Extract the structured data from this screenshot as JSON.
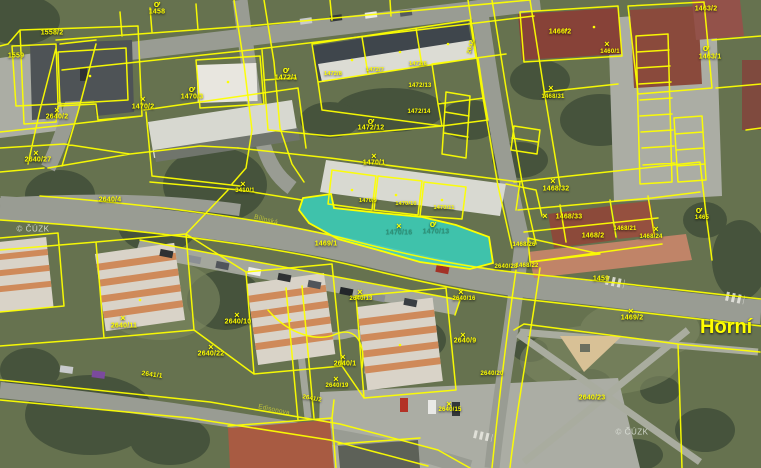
{
  "map": {
    "watermark": "© ČÚZK",
    "area_label": "Horní",
    "selected_parcels": [
      "1470/16",
      "1470/13"
    ],
    "colors": {
      "parcel_line": "#fdff00",
      "highlight_fill": "#35d8c5",
      "label_yellow": "#ffff00",
      "selected_label": "#2f8f76"
    },
    "labels": [
      {
        "t": "×",
        "x": 143,
        "y": 99,
        "k": "sym"
      },
      {
        "t": "×",
        "x": 57,
        "y": 110,
        "k": "sym"
      },
      {
        "t": "×",
        "x": 36,
        "y": 153,
        "k": "sym"
      },
      {
        "t": "×",
        "x": 243,
        "y": 184,
        "k": "sym"
      },
      {
        "t": "×",
        "x": 374,
        "y": 156,
        "k": "sym"
      },
      {
        "t": "×",
        "x": 399,
        "y": 226,
        "k": "sym"
      },
      {
        "t": "×",
        "x": 551,
        "y": 88,
        "k": "sym"
      },
      {
        "t": "×",
        "x": 553,
        "y": 181,
        "k": "sym"
      },
      {
        "t": "×",
        "x": 545,
        "y": 216,
        "k": "sym"
      },
      {
        "t": "×",
        "x": 656,
        "y": 229,
        "k": "sym"
      },
      {
        "t": "×",
        "x": 607,
        "y": 44,
        "k": "sym"
      },
      {
        "t": "×",
        "x": 631,
        "y": 311,
        "k": "sym"
      },
      {
        "t": "×",
        "x": 123,
        "y": 318,
        "k": "sym"
      },
      {
        "t": "×",
        "x": 237,
        "y": 315,
        "k": "sym"
      },
      {
        "t": "×",
        "x": 211,
        "y": 347,
        "k": "sym"
      },
      {
        "t": "×",
        "x": 343,
        "y": 357,
        "k": "sym"
      },
      {
        "t": "×",
        "x": 336,
        "y": 379,
        "k": "sym"
      },
      {
        "t": "×",
        "x": 463,
        "y": 335,
        "k": "sym"
      },
      {
        "t": "×",
        "x": 449,
        "y": 404,
        "k": "sym"
      },
      {
        "t": "×",
        "x": 360,
        "y": 292,
        "k": "sym"
      },
      {
        "t": "×",
        "x": 461,
        "y": 292,
        "k": "sym"
      },
      {
        "t": "ơ",
        "x": 157,
        "y": 4,
        "k": "g"
      },
      {
        "t": "ơ",
        "x": 192,
        "y": 89,
        "k": "g"
      },
      {
        "t": "ơ",
        "x": 286,
        "y": 70,
        "k": "g"
      },
      {
        "t": "ơ",
        "x": 371,
        "y": 121,
        "k": "g"
      },
      {
        "t": "ơ",
        "x": 433,
        "y": 224,
        "k": "g"
      },
      {
        "t": "ơ",
        "x": 699,
        "y": 210,
        "k": "g"
      },
      {
        "t": "ơ",
        "x": 706,
        "y": 48,
        "k": "g"
      },
      {
        "t": "1558/2",
        "x": 52,
        "y": 33
      },
      {
        "t": "1559",
        "x": 16,
        "y": 56
      },
      {
        "t": "1458",
        "x": 157,
        "y": 12
      },
      {
        "t": "1470/2",
        "x": 143,
        "y": 107
      },
      {
        "t": "1470/3",
        "x": 192,
        "y": 97
      },
      {
        "t": "2640/2",
        "x": 57,
        "y": 117
      },
      {
        "t": "2640/27",
        "x": 38,
        "y": 160
      },
      {
        "t": "2640/4",
        "x": 110,
        "y": 200
      },
      {
        "t": "3410/1",
        "x": 245,
        "y": 191,
        "s": 6
      },
      {
        "t": "1472/1",
        "x": 286,
        "y": 78
      },
      {
        "t": "1472/8",
        "x": 333,
        "y": 74,
        "s": 5.5
      },
      {
        "t": "1472/7",
        "x": 375,
        "y": 70,
        "s": 5.5
      },
      {
        "t": "1472/6",
        "x": 418,
        "y": 64,
        "s": 5.5
      },
      {
        "t": "1472/13",
        "x": 420,
        "y": 86,
        "s": 6
      },
      {
        "t": "1472/14",
        "x": 419,
        "y": 112,
        "s": 6
      },
      {
        "t": "1472/12",
        "x": 371,
        "y": 128
      },
      {
        "t": "2642",
        "x": 471,
        "y": 47,
        "s": 6,
        "r": -75
      },
      {
        "t": "1466/2",
        "x": 560,
        "y": 32
      },
      {
        "t": "1460/1",
        "x": 610,
        "y": 52,
        "s": 6
      },
      {
        "t": "1468/31",
        "x": 553,
        "y": 97,
        "s": 6
      },
      {
        "t": "1463/2",
        "x": 706,
        "y": 9
      },
      {
        "t": "1463/1",
        "x": 710,
        "y": 57
      },
      {
        "t": "1465",
        "x": 702,
        "y": 218,
        "s": 6
      },
      {
        "t": "1468/32",
        "x": 556,
        "y": 189
      },
      {
        "t": "1468/33",
        "x": 569,
        "y": 217
      },
      {
        "t": "1468/2",
        "x": 593,
        "y": 236
      },
      {
        "t": "1468/21",
        "x": 625,
        "y": 229,
        "s": 6
      },
      {
        "t": "1468/24",
        "x": 651,
        "y": 237,
        "s": 6
      },
      {
        "t": "1468/26",
        "x": 524,
        "y": 245,
        "s": 6
      },
      {
        "t": "1468/22",
        "x": 527,
        "y": 266,
        "s": 6
      },
      {
        "t": "1459",
        "x": 601,
        "y": 279
      },
      {
        "t": "1470/1",
        "x": 374,
        "y": 163
      },
      {
        "t": "1470/9",
        "x": 368,
        "y": 201,
        "s": 5.5
      },
      {
        "t": "1470/10",
        "x": 406,
        "y": 204,
        "s": 5.5
      },
      {
        "t": "1470/11",
        "x": 444,
        "y": 208,
        "s": 5.5
      },
      {
        "t": "1470/16",
        "x": 399,
        "y": 233,
        "k": "sel"
      },
      {
        "t": "1470/13",
        "x": 436,
        "y": 232,
        "k": "sel"
      },
      {
        "t": "1469/1",
        "x": 326,
        "y": 244
      },
      {
        "t": "2640/28",
        "x": 506,
        "y": 267,
        "s": 6
      },
      {
        "t": "2640/13",
        "x": 361,
        "y": 299,
        "s": 6
      },
      {
        "t": "2640/16",
        "x": 464,
        "y": 299,
        "s": 6
      },
      {
        "t": "1469/2",
        "x": 632,
        "y": 318
      },
      {
        "t": "2640/23",
        "x": 592,
        "y": 398
      },
      {
        "t": "2640/11",
        "x": 124,
        "y": 326
      },
      {
        "t": "2640/10",
        "x": 238,
        "y": 322
      },
      {
        "t": "2640/22",
        "x": 211,
        "y": 354
      },
      {
        "t": "2641/1",
        "x": 152,
        "y": 375,
        "s": 6.5,
        "r": 8
      },
      {
        "t": "2640/1",
        "x": 345,
        "y": 364
      },
      {
        "t": "2640/19",
        "x": 337,
        "y": 386,
        "s": 6
      },
      {
        "t": "2640/9",
        "x": 465,
        "y": 341
      },
      {
        "t": "2640/20",
        "x": 492,
        "y": 374,
        "s": 6
      },
      {
        "t": "2640/15",
        "x": 450,
        "y": 410,
        "s": 6
      },
      {
        "t": "2641/2",
        "x": 312,
        "y": 399,
        "s": 6,
        "r": 10
      },
      {
        "t": "Bílinská",
        "x": 266,
        "y": 220,
        "k": "street",
        "r": 14
      },
      {
        "t": "Edisonova",
        "x": 274,
        "y": 410,
        "k": "street",
        "r": 12
      }
    ]
  }
}
